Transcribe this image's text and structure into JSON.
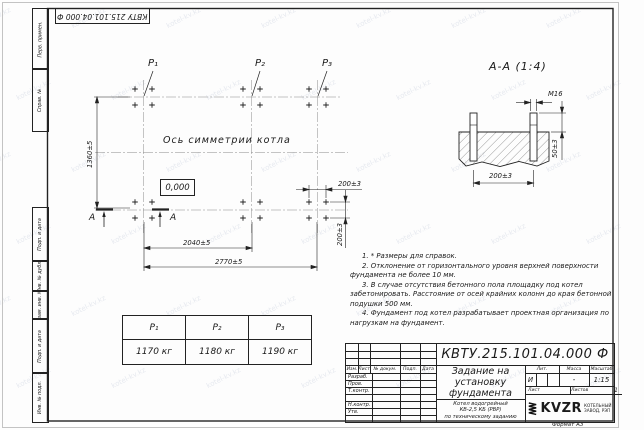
{
  "watermark": "kotel-kv.kz",
  "stamp_top": "КВТУ 215.101.04.000 Ф",
  "frame_labels": {
    "perv": "Перв. примен.",
    "sprav": "Справ. №",
    "podp1": "Подп. и дата",
    "inv_dubl": "Инв. № дубл.",
    "vzam": "Взам. инв. №",
    "podp2": "Подп. и дата",
    "inv_podl": "Инв. № подл."
  },
  "plan": {
    "p1": "P₁",
    "p2": "P₂",
    "p3": "P₃",
    "axis_label": "Ось симметрии котла",
    "level_mark": "0,000",
    "section_letter_1": "А",
    "section_letter_2": "А",
    "dim_height": "1360±5",
    "dim_span1": "2040±5",
    "dim_span2": "2770±5",
    "dim_bolt_h": "200±3",
    "dim_bolt_v": "200±3"
  },
  "section": {
    "title": "А-А (1:4)",
    "bolt_thread": "М16",
    "dim_width": "200±3",
    "dim_protrusion": "50±3"
  },
  "load_table": {
    "headers": [
      "P₁",
      "P₂",
      "P₃"
    ],
    "values": [
      "1170 кг",
      "1180 кг",
      "1190 кг"
    ]
  },
  "notes": [
    "1. * Размеры для справок.",
    "2. Отклонение от горизонтального уровня верхней поверхности фундамента не более 10 мм.",
    "3. В случае отсутствия бетонного пола площадку под котел забетонировать. Расстояние от осей крайних колонн до края бетонной подушки 500 мм.",
    "4. Фундамент под котел разрабатывает проектная организация по нагрузкам на фундамент."
  ],
  "title_block": {
    "doc_number": "КВТУ.215.101.04.000 Ф",
    "name_line1": "Задание на",
    "name_line2": "установку",
    "name_line3": "фундамента",
    "subject_line1": "Котел водогрейный",
    "subject_line2": "КВ-2,5 КБ (РВР)",
    "subject_line3": "по техническому заданию",
    "header_cells": [
      "Изм.",
      "Лист",
      "№ докум.",
      "Подп.",
      "Дата"
    ],
    "row_labels": [
      "Разраб.",
      "Пров.",
      "Т.контр.",
      "Н.контр.",
      "Утв."
    ],
    "lit_header": [
      "Лит.",
      "Масса",
      "Масштаб"
    ],
    "lit_value": "И",
    "mass_value": "-",
    "scale_value": "1:15",
    "sheet_label": "Лист",
    "sheets_label": "Листов",
    "sheets_value": "1",
    "logo_text": "KVZR",
    "logo_caption_1": "КОТЕЛЬНЫЙ",
    "logo_caption_2": "ЗАВОД, РЭП",
    "format_label": "Формат А3"
  }
}
